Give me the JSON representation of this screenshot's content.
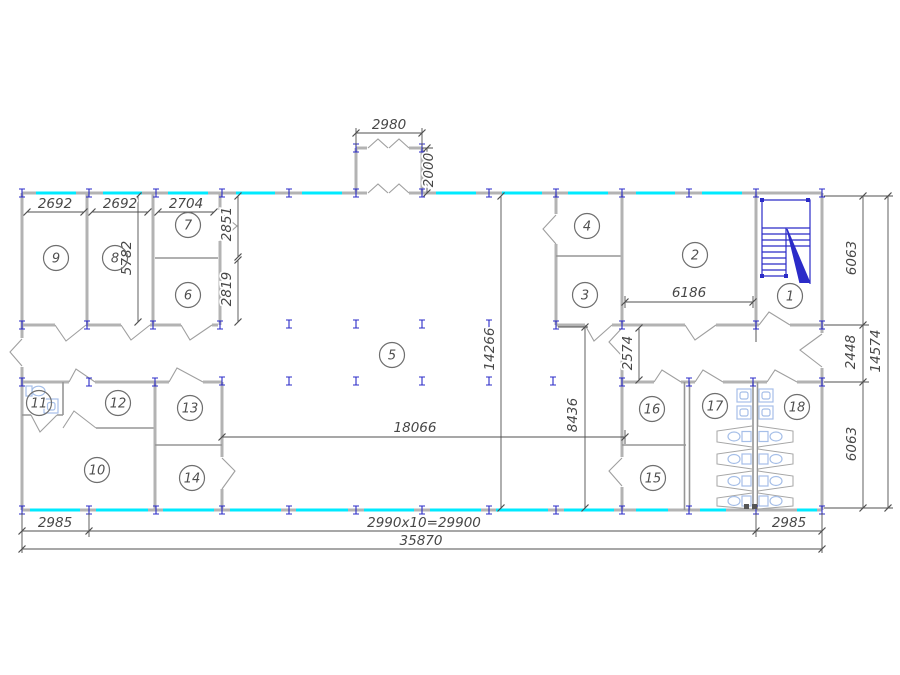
{
  "colors": {
    "background": "#ffffff",
    "wall": "#b3b3b3",
    "partition": "#969696",
    "window": "#00eaff",
    "structure": "#2b2bc8",
    "fixture": "#a6bfe8",
    "dimline": "#4f4f4f",
    "dimtext": "#474747",
    "label": "#4f4f4f"
  },
  "room_labels": [
    "1",
    "2",
    "3",
    "4",
    "5",
    "6",
    "7",
    "8",
    "9",
    "10",
    "11",
    "12",
    "13",
    "14",
    "15",
    "16",
    "17",
    "18"
  ],
  "dimensions": {
    "room9_width": "2692",
    "room8_width": "2692",
    "room7_width": "2704",
    "room8_depth": "5782",
    "room7_depth": "2851",
    "room6_depth": "2819",
    "porch_width": "2980",
    "porch_depth": "2000",
    "room2_width": "6186",
    "right_corridor_width": "2574",
    "hall_depth": "14266",
    "right_wing_depth": "8436",
    "hall_width": "18066",
    "right_chain_top": "6063",
    "right_chain_middle": "2448",
    "right_chain_bottom": "6063",
    "right_total_depth": "14574",
    "bottom_left_bay": "2985",
    "bottom_bay_run": "2990x10=29900",
    "bottom_right_bay": "2985",
    "bottom_total_width": "35870"
  }
}
